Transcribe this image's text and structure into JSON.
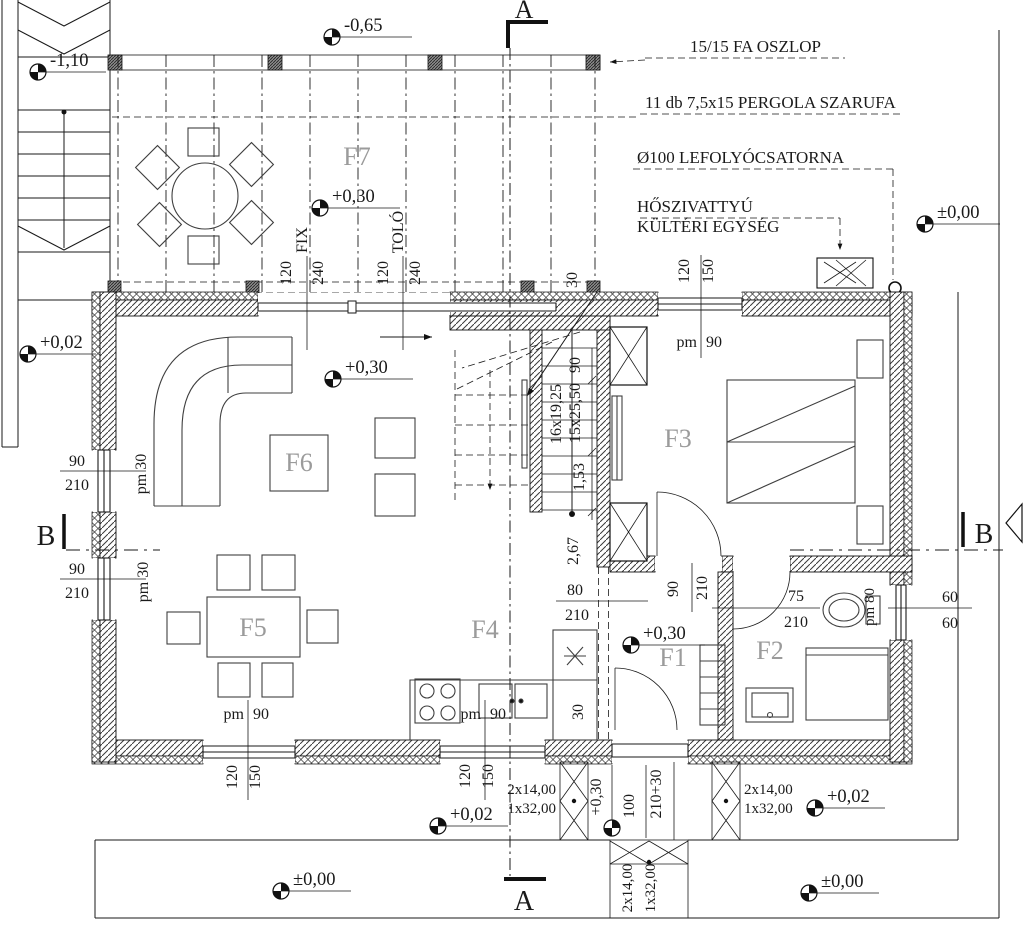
{
  "sections": {
    "a": "A",
    "b": "B"
  },
  "rooms": {
    "f1": "F1",
    "f2": "F2",
    "f3": "F3",
    "f4": "F4",
    "f5": "F5",
    "f6": "F6",
    "f7": "F7"
  },
  "levels": {
    "minus110": "-1,10",
    "minus065": "-0,65",
    "plus030": "+0,30",
    "plus002": "+0,02",
    "zero": "±0,00"
  },
  "annotations": {
    "post": "15/15 FA OSZLOP",
    "rafter": "11 db 7,5x15 PERGOLA SZARUFA",
    "downpipe": "Ø100 LEFOLYÓCSATORNA",
    "heatpump1": "HŐSZIVATTYÚ",
    "heatpump2": "KÜLTÉRI EGYSÉG"
  },
  "dim_texts": {
    "d30": "30",
    "d60": "60",
    "d75": "75",
    "d80": "80",
    "d90": "90",
    "d100": "100",
    "d120": "120",
    "d150": "150",
    "d210": "210",
    "d240": "240",
    "d210plus30": "210+30",
    "d153": "1,53",
    "d267": "2,67",
    "risers": "16x19,25",
    "treads": "15x25,50",
    "steps14": "2x14,00",
    "steps32": "1x32,00",
    "pm": "pm",
    "pm30": "pm 30",
    "pm80": "pm 80",
    "fix": "FIX",
    "tolo": "TOLÓ"
  }
}
